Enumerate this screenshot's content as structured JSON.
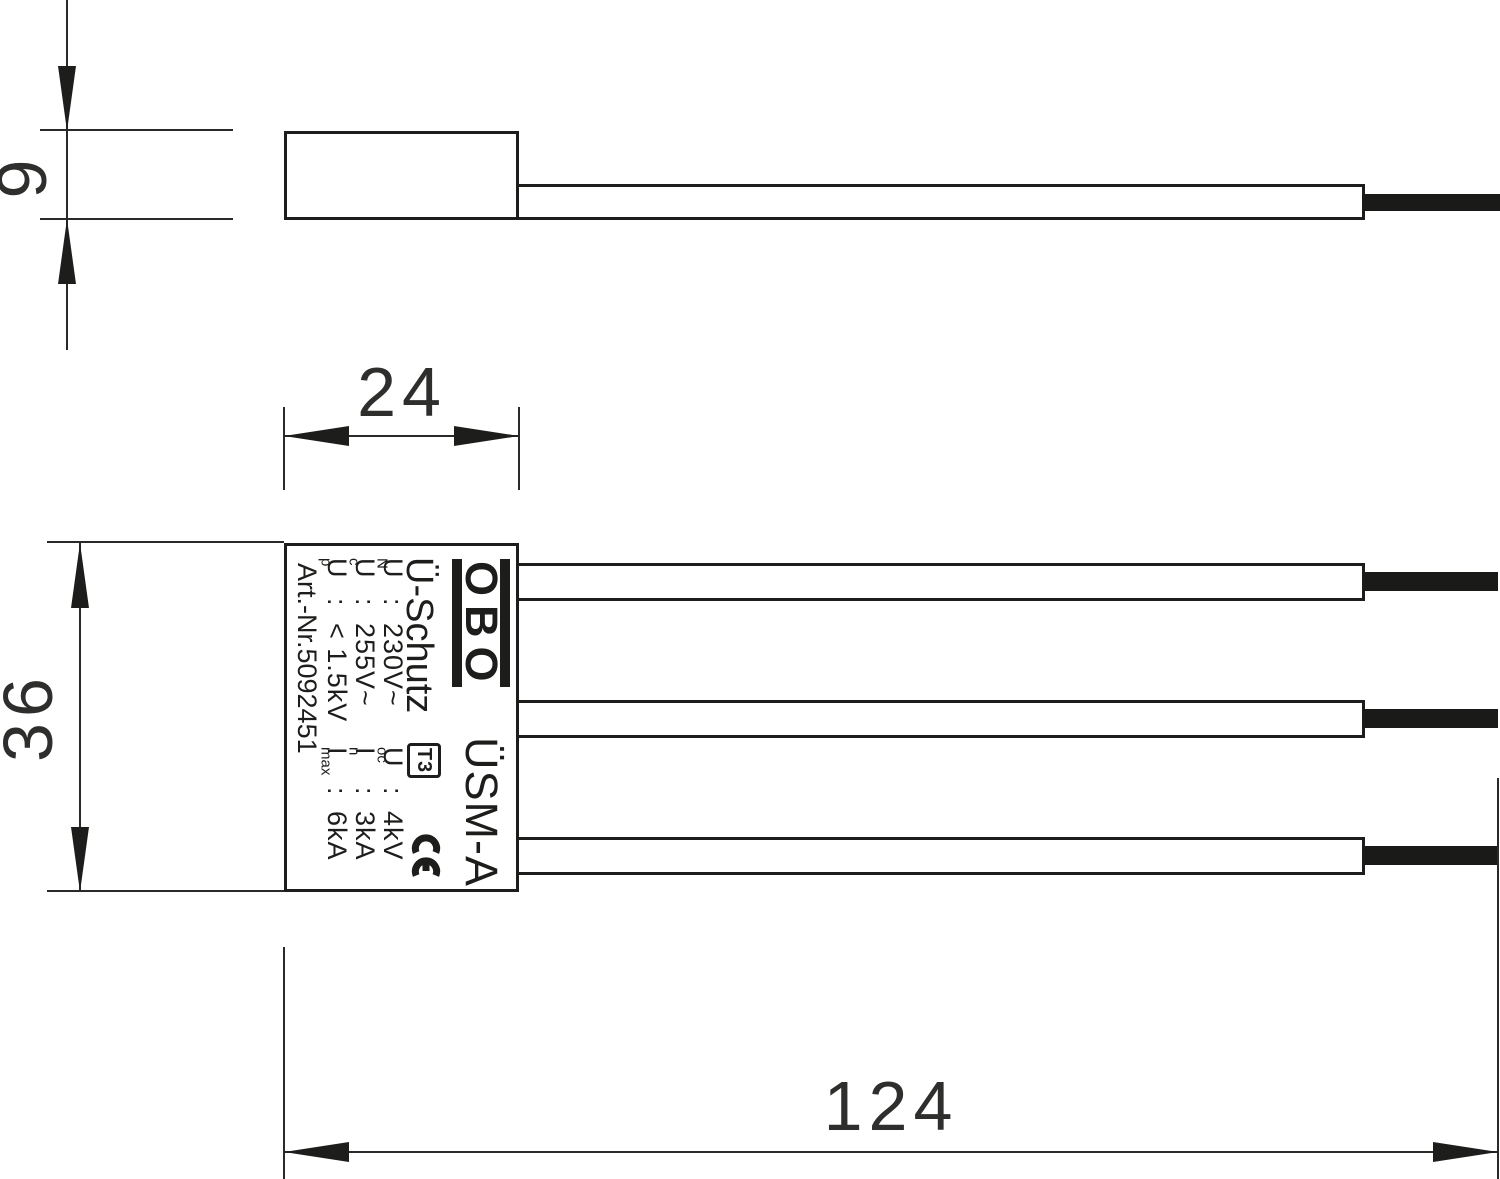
{
  "dimensions": {
    "side_height_mm": "9",
    "front_width_mm": "24",
    "front_height_mm": "36",
    "overall_length_mm": "124"
  },
  "label": {
    "logo_text": "OBO",
    "product_name": "ÜSM-A",
    "protection_title": "Ü-Schutz",
    "t3_badge": "T3",
    "ce_mark": "CE",
    "colon": ":",
    "specs_left": [
      {
        "symbol": "U",
        "subscript": "N",
        "value": "230V~"
      },
      {
        "symbol": "U",
        "subscript": "c",
        "value": "255V~"
      },
      {
        "symbol": "U",
        "subscript": "p",
        "value": "< 1.5kV"
      }
    ],
    "specs_right": [
      {
        "symbol": "U",
        "subscript": "oc",
        "value": "4kV"
      },
      {
        "symbol": "I",
        "subscript": "n",
        "value": "3kA"
      },
      {
        "symbol": "I",
        "subscript": "max",
        "value": "6kA"
      }
    ],
    "article_number": "Art.-Nr.5092451"
  },
  "colors": {
    "ink": "#1d1d1b",
    "dim_text": "#2e2e2c",
    "wire_end": "#1a1a18",
    "background": "#ffffff"
  }
}
